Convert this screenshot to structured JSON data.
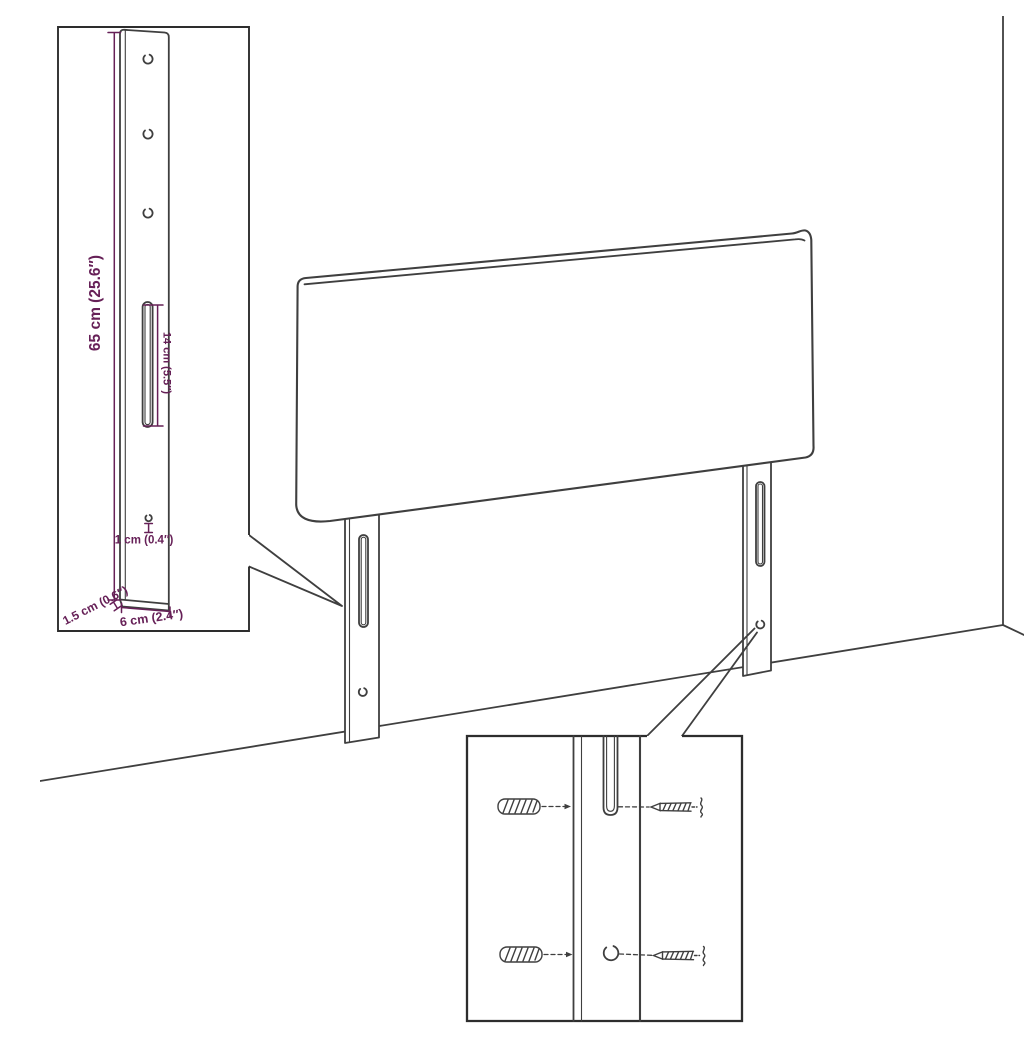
{
  "title": "Headboard with legs - product dimension diagram",
  "colors": {
    "background": "#ffffff",
    "outline": "#3f3f3f",
    "inset_border": "#2d2d2d",
    "dimension": "#662057"
  },
  "dimensions": {
    "bracket_height": "65 cm (25.6″)",
    "slot_length": "14 cm (5.5″)",
    "hole_diameter": "1 cm (0.4″)",
    "bracket_thickness": "1.5 cm (0.6″)",
    "bracket_width": "6 cm (2.4″)"
  },
  "icons": {
    "wall_plug": "hatched-anchor-shape",
    "screw": "pointed-threaded-screw-shape"
  }
}
